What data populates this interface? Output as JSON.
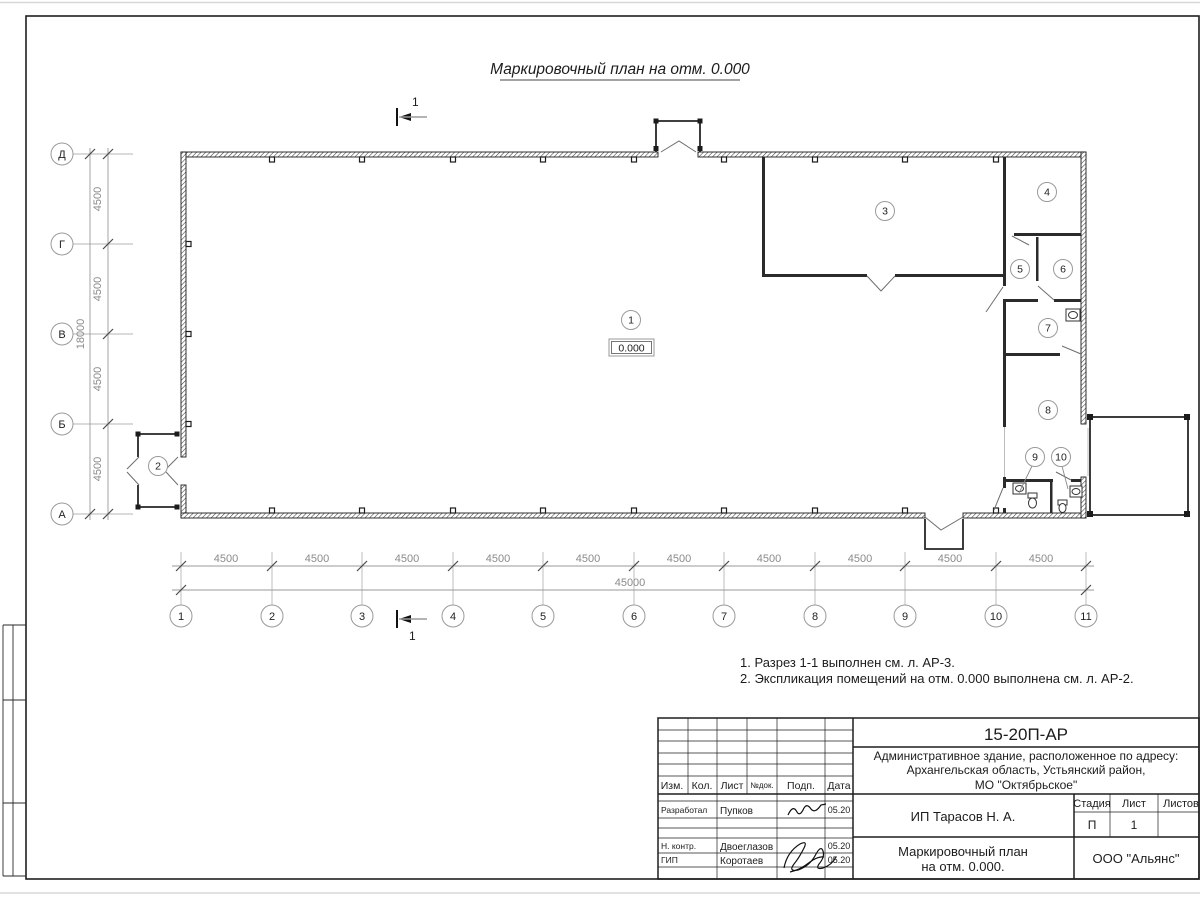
{
  "sheet": {
    "plan_title": "Маркировочный план на отм. 0.000",
    "notes": [
      "1. Разрез 1-1 выполнен см. л. АР-3.",
      "2. Экспликация помещений на отм. 0.000 выполнена см. л. АР-2."
    ]
  },
  "plan": {
    "row_axes": [
      "Д",
      "Г",
      "В",
      "Б",
      "А"
    ],
    "col_axes": [
      "1",
      "2",
      "3",
      "4",
      "5",
      "6",
      "7",
      "8",
      "9",
      "10",
      "11"
    ],
    "rooms": [
      "1",
      "2",
      "3",
      "4",
      "5",
      "6",
      "7",
      "8",
      "9",
      "10"
    ],
    "elevation_mark": "0.000",
    "section_mark": "1",
    "dims": {
      "bay": "4500",
      "total_width": "45000",
      "total_height": "18000"
    }
  },
  "title_block": {
    "doc_number": "15-20П-АР",
    "project_address_lines": [
      "Административное здание, расположенное по адресу:",
      "Архангельская область, Устьянский район,",
      "МО \"Октябрьское\""
    ],
    "client": "ИП Тарасов Н. А.",
    "drawing_title_lines": [
      "Маркировочный план",
      "на отм. 0.000."
    ],
    "company": "ООО \"Альянс\"",
    "header": {
      "izm": "Изм.",
      "kol": "Кол.",
      "list": "Лист",
      "ndok": "№док.",
      "podp": "Подп.",
      "data": "Дата"
    },
    "stage": {
      "label": "Стадия",
      "value": "П"
    },
    "sheet": {
      "label": "Лист",
      "value": "1"
    },
    "sheets": {
      "label": "Листов"
    },
    "signatures": [
      {
        "role": "Разработал",
        "name": "Пупков",
        "date": "05.20"
      },
      {
        "role": "Н. контр.",
        "name": "Двоеглазов",
        "date": "05.20"
      },
      {
        "role": "ГИП",
        "name": "Коротаев",
        "date": "05.20"
      }
    ]
  }
}
